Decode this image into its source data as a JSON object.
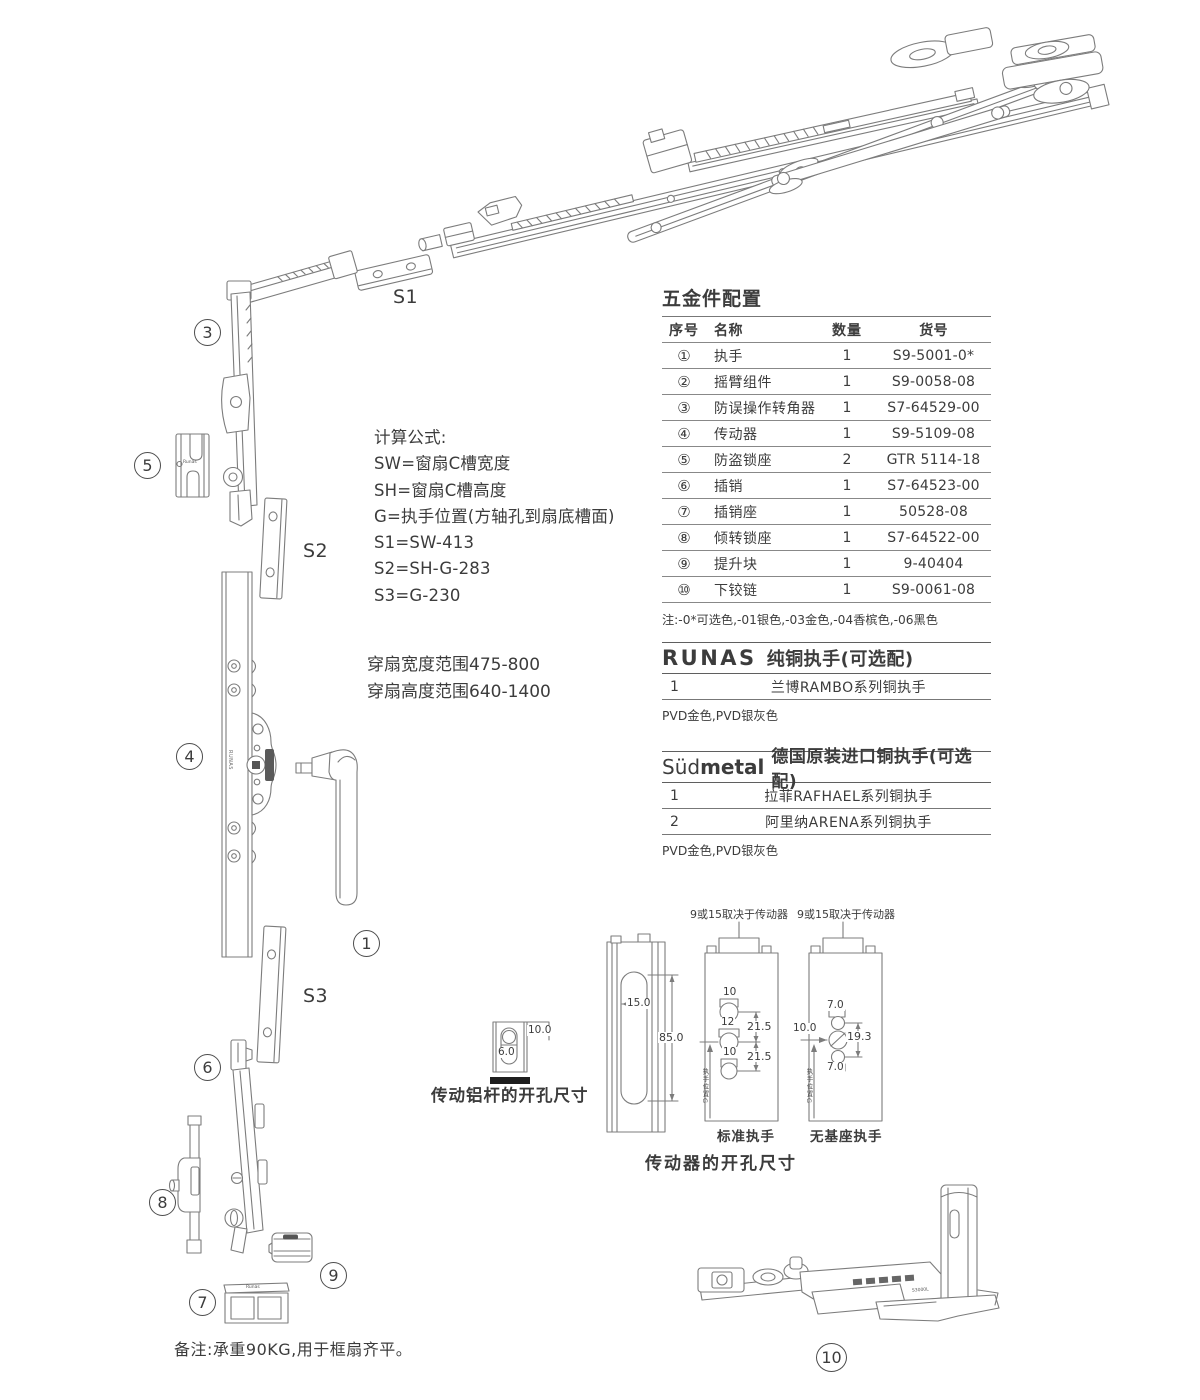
{
  "colors": {
    "ink": "#3c3c3c",
    "line": "#7c7c7c"
  },
  "callouts": {
    "c1": "1",
    "c3": "3",
    "c4": "4",
    "c5": "5",
    "c6": "6",
    "c7": "7",
    "c8": "8",
    "c9": "9",
    "c10": "10"
  },
  "size_labels": {
    "s1": "S1",
    "s2": "S2",
    "s3": "S3"
  },
  "formula": {
    "title": "计算公式:",
    "lines": [
      "SW=窗扇C槽宽度",
      "SH=窗扇C槽高度",
      "G=执手位置(方轴孔到扇底槽面)",
      "S1=SW-413",
      "S2=SH-G-283",
      "S3=G-230"
    ]
  },
  "sash_range": [
    "穿扇宽度范围475-800",
    "穿扇高度范围640-1400"
  ],
  "hardware_table": {
    "title": "五金件配置",
    "headers": [
      "序号",
      "名称",
      "数量",
      "货号"
    ],
    "rows": [
      [
        "①",
        "执手",
        "1",
        "S9-5001-0*"
      ],
      [
        "②",
        "摇臂组件",
        "1",
        "S9-0058-08"
      ],
      [
        "③",
        "防误操作转角器",
        "1",
        "S7-64529-00"
      ],
      [
        "④",
        "传动器",
        "1",
        "S9-5109-08"
      ],
      [
        "⑤",
        "防盗锁座",
        "2",
        "GTR 5114-18"
      ],
      [
        "⑥",
        "插销",
        "1",
        "S7-64523-00"
      ],
      [
        "⑦",
        "插销座",
        "1",
        "50528-08"
      ],
      [
        "⑧",
        "倾转锁座",
        "1",
        "S7-64522-00"
      ],
      [
        "⑨",
        "提升块",
        "1",
        "9-40404"
      ],
      [
        "⑩",
        "下铰链",
        "1",
        "S9-0061-08"
      ]
    ],
    "note": "注:-0*可选色,-01银色,-03金色,-04香槟色,-06黑色"
  },
  "runas_section": {
    "brand": "RUNAS",
    "title": "纯铜执手(可选配)",
    "rows": [
      [
        "1",
        "兰博RAMBO系列铜执手"
      ]
    ],
    "finish": "PVD金色,PVD银灰色"
  },
  "sudmetal_section": {
    "brand_prefix": "Süd",
    "brand_suffix": "metal",
    "title": "德国原装进口铜执手(可选配)",
    "rows": [
      [
        "1",
        "拉菲RAFHAEL系列铜执手"
      ],
      [
        "2",
        "阿里纳ARENA系列铜执手"
      ]
    ],
    "finish": "PVD金色,PVD银灰色"
  },
  "drill_rod": {
    "label": "传动铝杆的开孔尺寸",
    "width_dim": "10.0",
    "hole_dim": "6.0"
  },
  "drill_driver": {
    "caption": "传动器的开孔尺寸",
    "depends_note": "9或15取决于传动器",
    "profile": {
      "slot_width": "15.0",
      "slot_height": "85.0"
    },
    "standard": {
      "label": "标准执手",
      "hole_dims": [
        "10",
        "12",
        "10"
      ],
      "spacings": [
        "21.5",
        "21.5"
      ],
      "axis_label": "执手位置G"
    },
    "no_base": {
      "label": "无基座执手",
      "top_dim": "7.0",
      "left_dim": "10.0",
      "span_dim": "19.3",
      "bottom_dim": "7.0",
      "axis_label": "执手位置G"
    }
  },
  "bottom_note": "备注:承重90KG,用于框扇齐平。",
  "engravings": {
    "runas_small": "Runas",
    "runas_bar": "RUNAS",
    "hinge_code": "S3000L"
  }
}
